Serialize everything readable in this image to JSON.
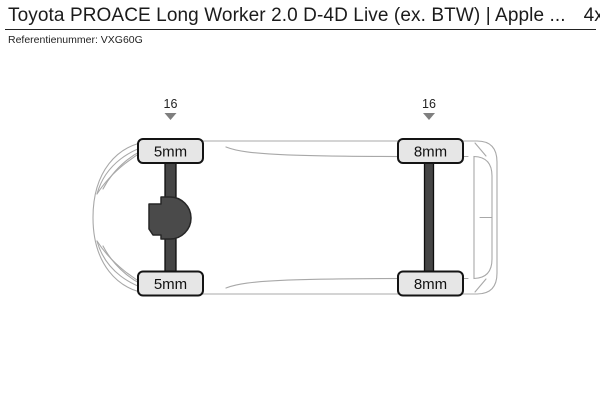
{
  "header": {
    "title": "Toyota PROACE Long Worker 2.0 D-4D Live (ex. BTW) | Apple ...",
    "drivetrain": "4x2",
    "reference_label": "Referentienummer:",
    "reference_value": "VXG60G"
  },
  "diagram": {
    "front_axle": {
      "rim_size": "16",
      "tire_top_tread": "5mm",
      "tire_bottom_tread": "5mm"
    },
    "rear_axle": {
      "rim_size": "16",
      "tire_top_tread": "8mm",
      "tire_bottom_tread": "8mm"
    }
  },
  "colors": {
    "tire_fill": "#e6e6e6",
    "tire_border": "#141414",
    "axle_fill": "#454545",
    "body_outline": "#a8a8a8",
    "arrow_marker": "#7f7f7f",
    "divider": "#222222",
    "text": "#1b1b1b"
  }
}
